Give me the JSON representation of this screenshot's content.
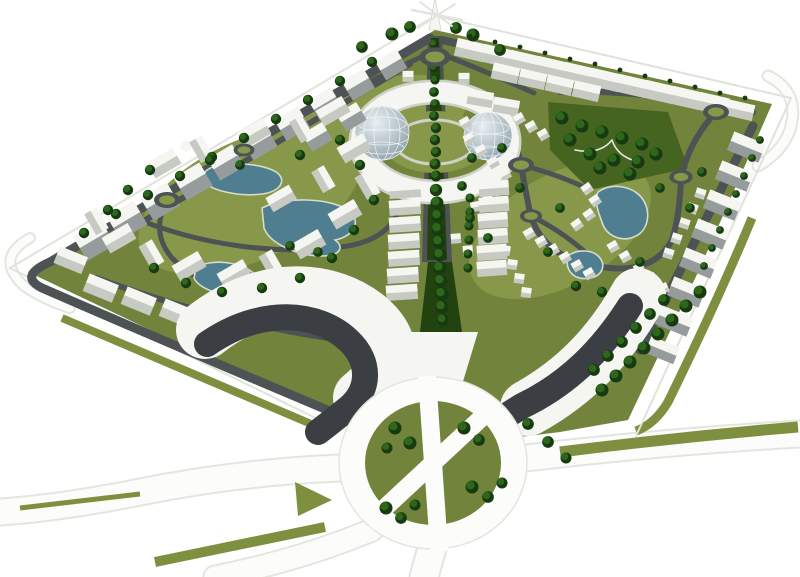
{
  "meta": {
    "description": "Aerial 3D architectural rendering of a residential master plan on a white background",
    "alt": "Bird's-eye 3D render of a diamond-shaped planned city district: a tree-lined central boulevard leads from a white spire monument at the top corner to a white ring building with two geodesic glass domes at the center; clusters of white apartment blocks and villas sit on olive-green lawns with teal ponds and small green roundabouts; a sweeping white building with a dark glass band curves around a large landscaped traffic circle at the bottom, with white roads, olive median strips and rows of dark green trees radiating outward."
  },
  "palette": {
    "background": "#ffffff",
    "lawn": "#72833c",
    "lawnLight": "#87984a",
    "park": "#44641f",
    "treeDark": "#173a10",
    "treeMid": "#2d671c",
    "road": "#4d5254",
    "medianTrees": "#22430f",
    "whiteRoad": "#fcfcfa",
    "roadEdge": "#e3e6dd",
    "median": "#7e9040",
    "building": "#f5f6f1",
    "buildingShade": "#c6cac2",
    "slabFace": "#969c9c",
    "glass": "#3b3f43",
    "water": "#4e7e8f",
    "pondEdge": "#d7dccb",
    "domeLight": "#e8eef0",
    "domeDark": "#8fa2ad",
    "domeGrid": "#eef3f4",
    "ringWalk": "#cdd1c6",
    "berm": "#e0e3d9",
    "spire": "#e2e5df"
  },
  "scene": {
    "site_shape": "skewed diamond viewed in aerial perspective",
    "landmarks": [
      "spire-monument-at-north-corner",
      "central-tree-lined-boulevard",
      "ring-building-with-twin-glass-domes",
      "wave-building-with-dark-glass-band",
      "grand-roundabout-with-tree-quadrants"
    ],
    "pond_count": 5,
    "small_roundabout_count": 7,
    "quadrants": [
      "west-apartment-quarter",
      "east-villa-quarter",
      "central-park",
      "southern-crescent"
    ]
  }
}
